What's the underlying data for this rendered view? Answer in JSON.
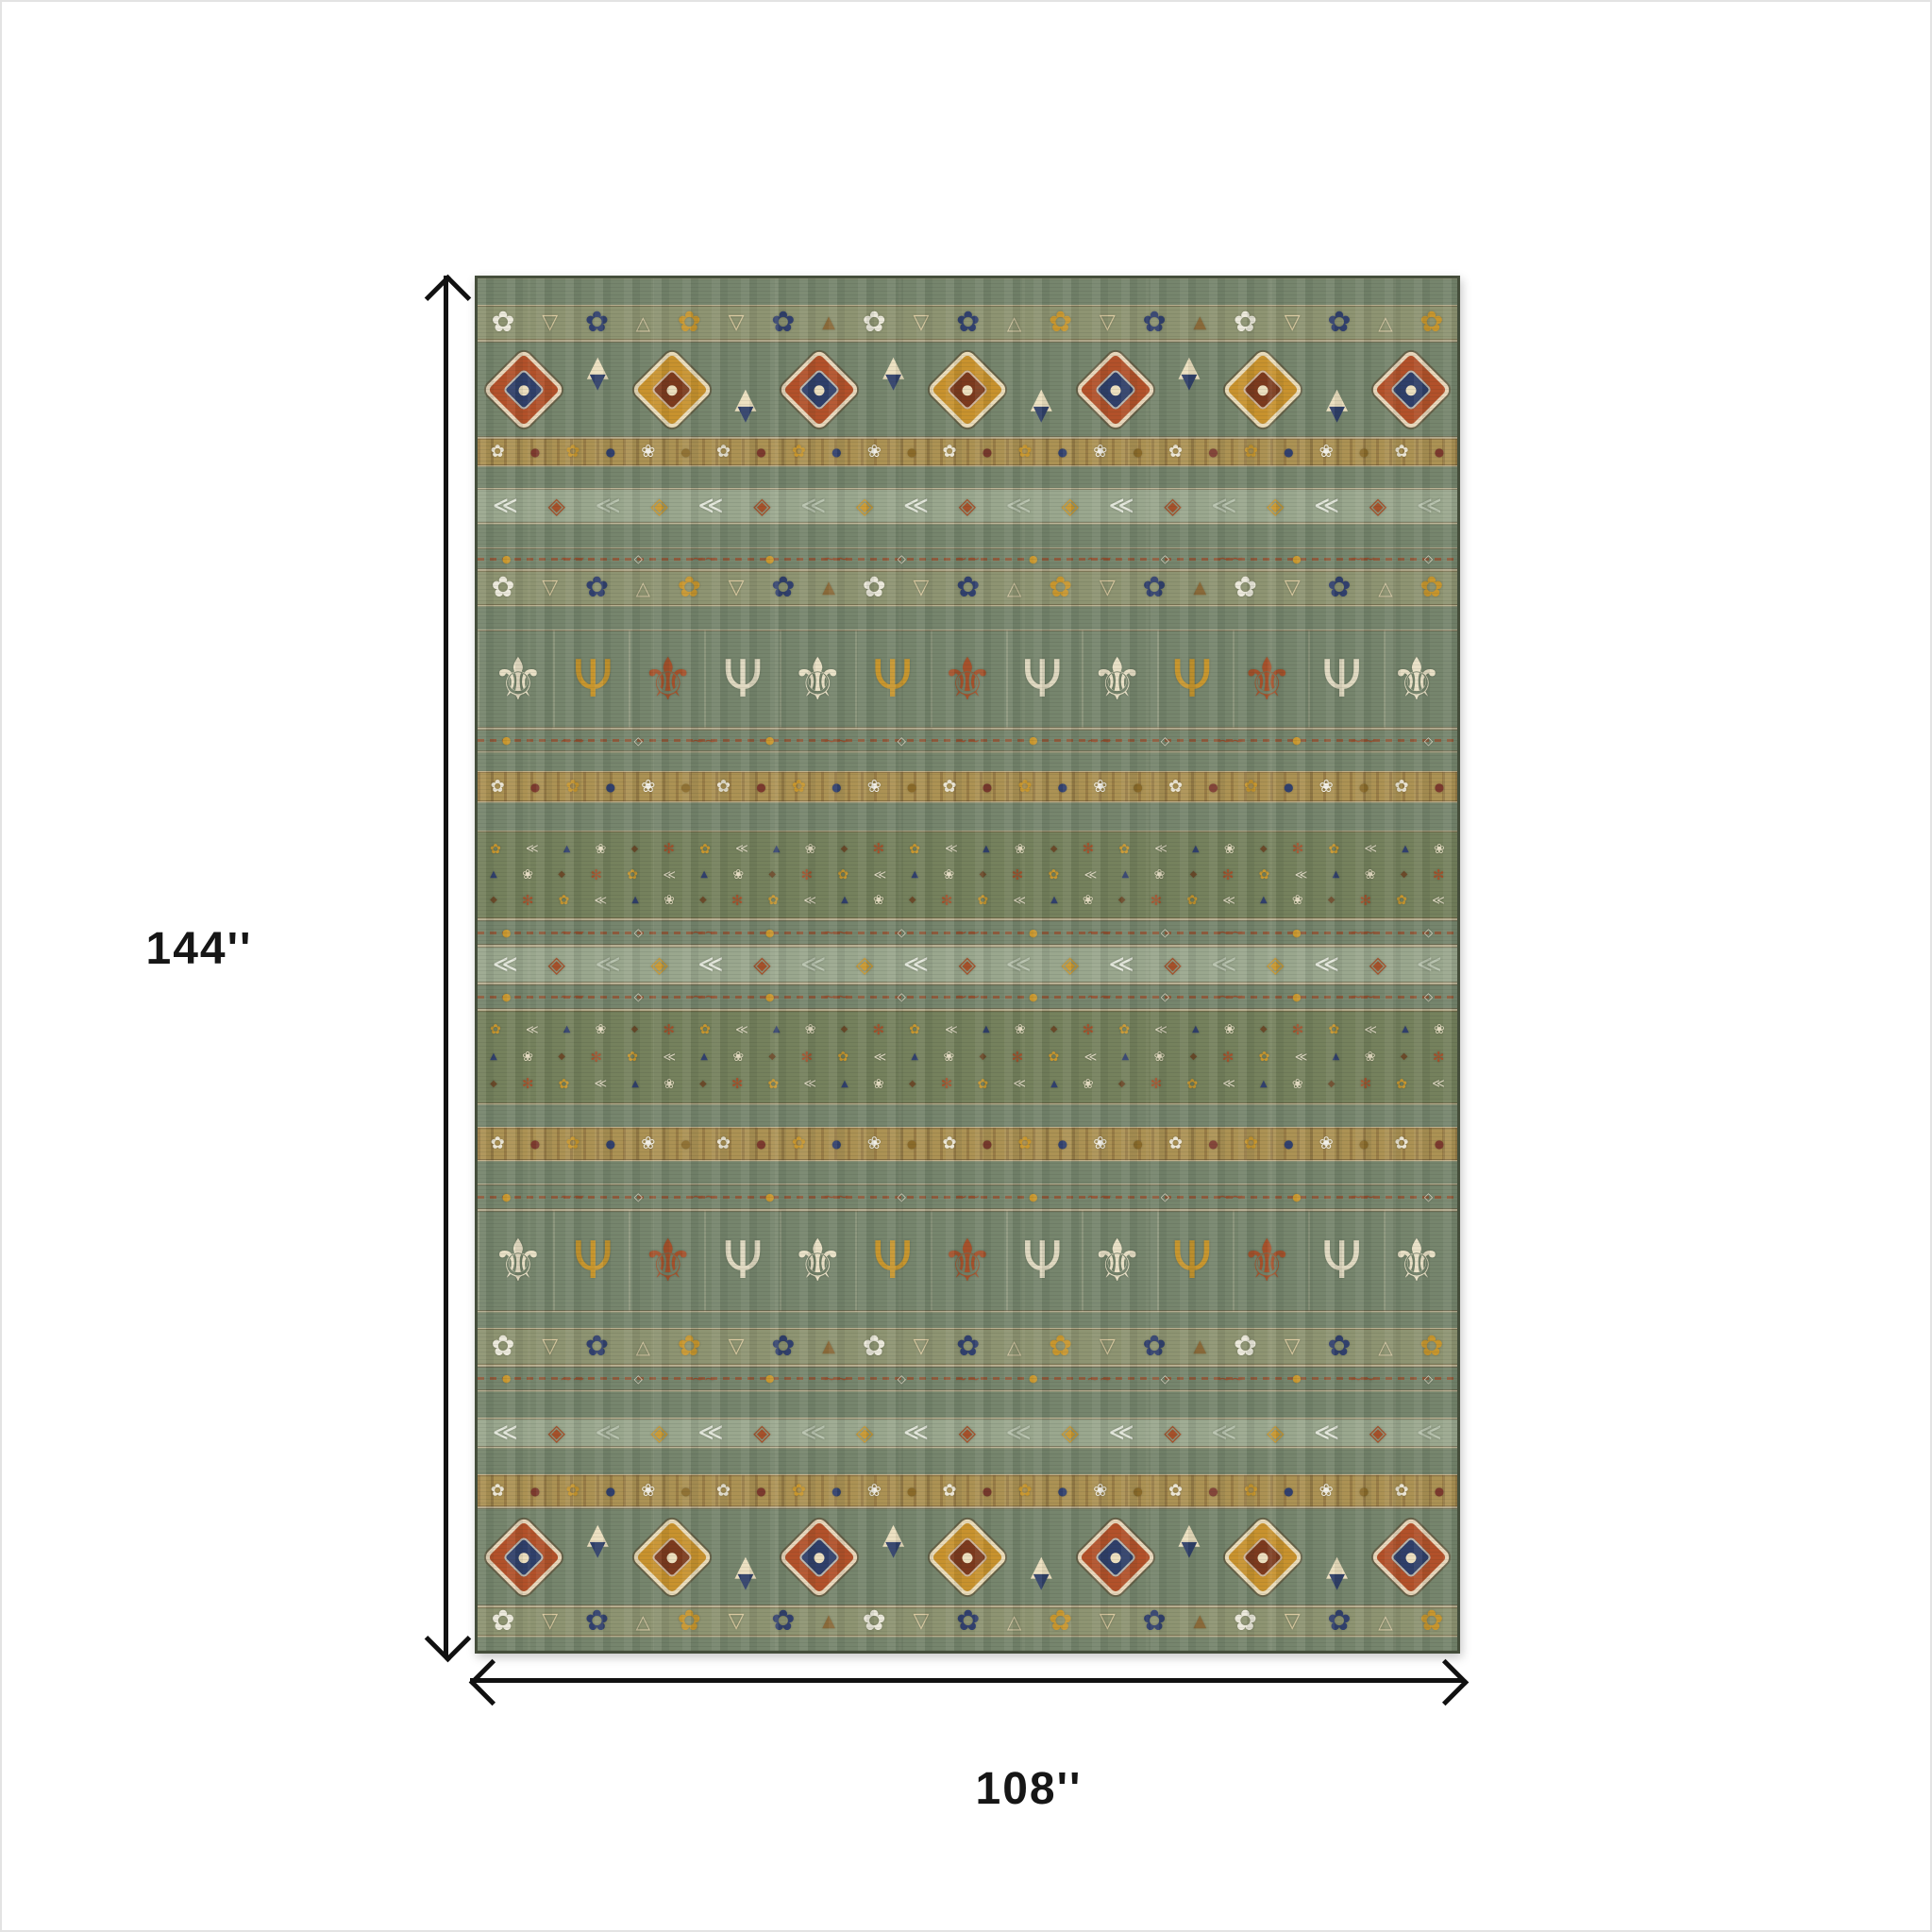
{
  "page": {
    "background": "#ffffff",
    "frame_color": "#e3e3e3"
  },
  "annotation": {
    "height_label": "144''",
    "width_label": "108''",
    "arrow_color": "#111111",
    "label_color": "#161616"
  },
  "rug": {
    "description": "southwestern-tribal-striped-area-rug-photo",
    "palette": {
      "base": "#76856d",
      "olive": "#75815d",
      "flowers_bg": "#8e9472",
      "chevron_bg": "#9aa78e",
      "dense_bg": "#ac9254",
      "edge": "#454e3b",
      "tan": "#b08d52",
      "cream": "#ecdfbf",
      "gold": "#c8922e",
      "rust": "#b2512a",
      "navy": "#2f3f6a",
      "maroon": "#7c3a2e",
      "white": "#f0ede4"
    },
    "bands": [
      {
        "t": "plain",
        "h": 28
      },
      {
        "t": "flowers",
        "h": 38
      },
      {
        "t": "medallions",
        "h": 103
      },
      {
        "t": "dense",
        "h": 30
      },
      {
        "t": "plain",
        "h": 23
      },
      {
        "t": "chevron",
        "h": 38
      },
      {
        "t": "plain",
        "h": 25
      },
      {
        "t": "scroll",
        "h": 24
      },
      {
        "t": "flowers",
        "h": 38
      },
      {
        "t": "plain",
        "h": 25
      },
      {
        "t": "candelabra",
        "h": 105
      },
      {
        "t": "scroll",
        "h": 25
      },
      {
        "t": "plain",
        "h": 20
      },
      {
        "t": "dense",
        "h": 33
      },
      {
        "t": "plain",
        "h": 30
      },
      {
        "t": "floral",
        "h": 94
      },
      {
        "t": "scroll",
        "h": 28
      },
      {
        "t": "chevron",
        "h": 40
      },
      {
        "t": "scroll",
        "h": 28
      },
      {
        "t": "floral",
        "h": 100
      },
      {
        "t": "plain",
        "h": 24
      },
      {
        "t": "dense",
        "h": 36
      },
      {
        "t": "plain",
        "h": 24
      },
      {
        "t": "scroll",
        "h": 28
      },
      {
        "t": "candelabra",
        "h": 108
      },
      {
        "t": "plain",
        "h": 17
      },
      {
        "t": "flowers",
        "h": 40
      },
      {
        "t": "scroll",
        "h": 27
      },
      {
        "t": "plain",
        "h": 28
      },
      {
        "t": "chevron",
        "h": 32
      },
      {
        "t": "plain",
        "h": 28
      },
      {
        "t": "dense",
        "h": 35
      },
      {
        "t": "medallions",
        "h": 105
      },
      {
        "t": "flowers",
        "h": 32
      },
      {
        "t": "plain",
        "h": 20
      }
    ],
    "motifs": {
      "flowers": {
        "count": 21,
        "items": [
          {
            "n": "flower-icon",
            "g": "✿",
            "c": "#ece9dc",
            "s": 30
          },
          {
            "n": "goblet-icon",
            "g": "▽",
            "c": "#d9c9a0",
            "s": 22
          },
          {
            "n": "flower-icon",
            "g": "✿",
            "c": "#31406e",
            "s": 30
          },
          {
            "n": "triangle-icon",
            "g": "△",
            "c": "#cfc3a0",
            "s": 20
          },
          {
            "n": "flower-icon",
            "g": "✿",
            "c": "#c8962e",
            "s": 30
          },
          {
            "n": "goblet-icon",
            "g": "▽",
            "c": "#d9c9a0",
            "s": 22
          },
          {
            "n": "flower-icon",
            "g": "✿",
            "c": "#31406e",
            "s": 30
          },
          {
            "n": "triangle-icon",
            "g": "▲",
            "c": "#8a6a3a",
            "s": 18
          }
        ]
      },
      "dense": {
        "count": 26,
        "items": [
          {
            "n": "rosette-icon",
            "g": "✿",
            "c": "#ece6d6",
            "s": 18
          },
          {
            "n": "dot-icon",
            "g": "●",
            "c": "#7c3a2e",
            "s": 12
          },
          {
            "n": "rosette-icon",
            "g": "✿",
            "c": "#c8962e",
            "s": 18
          },
          {
            "n": "dot-icon",
            "g": "●",
            "c": "#31406e",
            "s": 12
          },
          {
            "n": "rosette-icon",
            "g": "❀",
            "c": "#f2efe6",
            "s": 18
          },
          {
            "n": "dot-icon",
            "g": "●",
            "c": "#8a6a2a",
            "s": 12
          }
        ]
      },
      "chevron": {
        "count": 19,
        "items": [
          {
            "n": "chevron-icon",
            "g": "≪",
            "c": "#e3e7dc",
            "s": 26
          },
          {
            "n": "diamond-icon",
            "g": "◈",
            "c": "#a5512b",
            "s": 24
          },
          {
            "n": "chevron-icon",
            "g": "≪",
            "c": "#b9c4b0",
            "s": 26
          },
          {
            "n": "diamond-icon",
            "g": "◈",
            "c": "#c8962e",
            "s": 24
          }
        ]
      },
      "scroll": {
        "count": 15,
        "items": [
          {
            "n": "dot-icon",
            "g": "●",
            "c": "#c8962e",
            "s": 11
          },
          {
            "n": "scroll-icon",
            "g": "∼∼",
            "c": "#9a4f2e",
            "s": 16
          },
          {
            "n": "diamond-icon",
            "g": "◇",
            "c": "#e8e2d0",
            "s": 12
          },
          {
            "n": "scroll-icon",
            "g": "∼∼",
            "c": "#9a4f2e",
            "s": 16
          }
        ]
      },
      "candelabra": {
        "count": 13,
        "items": [
          {
            "n": "tulip-icon",
            "g": "⚜",
            "c": "#e9e0c6",
            "s": 62
          },
          {
            "n": "sprig-icon",
            "g": "Ψ",
            "c": "#c8962e",
            "s": 54
          },
          {
            "n": "tulip-icon",
            "g": "⚜",
            "c": "#a5512b",
            "s": 62
          },
          {
            "n": "sprig-icon",
            "g": "Ψ",
            "c": "#dfd8c0",
            "s": 54
          }
        ]
      },
      "floral": {
        "count": 28,
        "rows": 3,
        "items": [
          {
            "n": "sprout-icon",
            "g": "✻",
            "c": "#a5512b",
            "s": 15
          },
          {
            "n": "flower-icon",
            "g": "✿",
            "c": "#c8962e",
            "s": 14
          },
          {
            "n": "chevron-icon",
            "g": "≪",
            "c": "#dcd6c0",
            "s": 13
          },
          {
            "n": "bud-icon",
            "g": "▲",
            "c": "#31406e",
            "s": 10
          },
          {
            "n": "flower-icon",
            "g": "❀",
            "c": "#e5dcc2",
            "s": 14
          },
          {
            "n": "diamond-icon",
            "g": "◆",
            "c": "#6b4a2a",
            "s": 10
          }
        ]
      },
      "medallions": {
        "cells": 13,
        "glyph_top": "▲",
        "glyph_bottom": "▼"
      }
    }
  }
}
